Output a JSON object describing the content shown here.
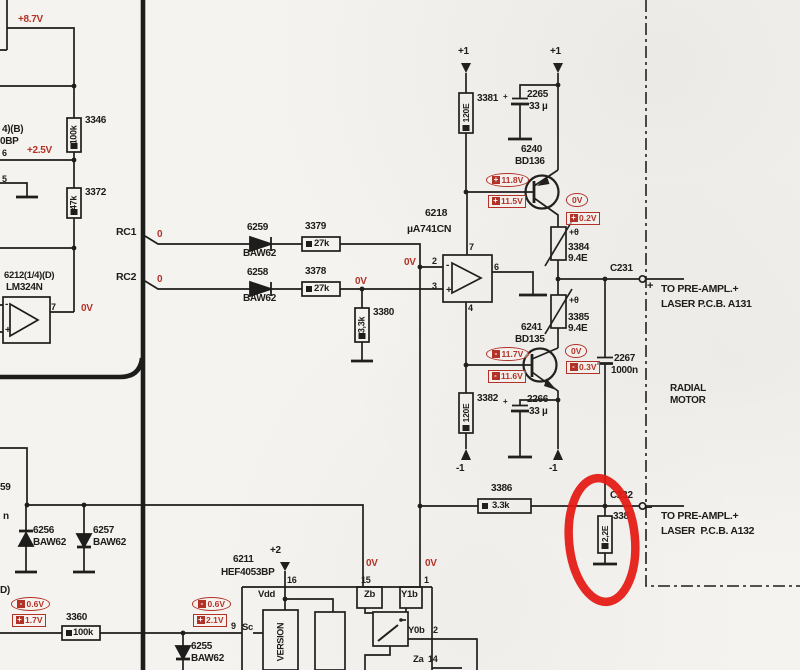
{
  "colors": {
    "line": "#1d1d1b",
    "print_red": "#b23227",
    "highlight_red": "#e41a12",
    "paper": "#f5f3ef"
  },
  "highlight": {
    "shape": "hand-drawn-ellipse",
    "around": "2.2E resistor at connector C232"
  },
  "labels": [
    {
      "n": "voltage-8p7v",
      "t": "+8.7V",
      "x": 18,
      "y": 15,
      "c": "r"
    },
    {
      "n": "frag-ic-b",
      "t": "4)(B)",
      "x": 2,
      "y": 125,
      "c": "b"
    },
    {
      "n": "frag-ic-bp",
      "t": "0BP",
      "x": 0,
      "y": 137,
      "c": "b"
    },
    {
      "n": "res-3346-id",
      "t": "3346",
      "x": 85,
      "y": 116,
      "c": "b"
    },
    {
      "n": "res-3346-val",
      "t": "100k",
      "x": 74,
      "y": 135,
      "c": "b",
      "rot": 1,
      "s": 9
    },
    {
      "n": "voltage-2p5v",
      "t": "+2.5V",
      "x": 27,
      "y": 146,
      "c": "r"
    },
    {
      "n": "pin-6-left",
      "t": "6",
      "x": 2,
      "y": 149,
      "c": "b",
      "s": 9
    },
    {
      "n": "pin-5-left",
      "t": "5",
      "x": 2,
      "y": 175,
      "c": "b",
      "s": 9
    },
    {
      "n": "res-3372-id",
      "t": "3372",
      "x": 85,
      "y": 188,
      "c": "b"
    },
    {
      "n": "res-3372-val",
      "t": "47k",
      "x": 74,
      "y": 203,
      "c": "b",
      "rot": 1,
      "s": 9
    },
    {
      "n": "ic-6212-id",
      "t": "6212(1/4)(D)",
      "x": 4,
      "y": 271,
      "c": "b",
      "s": 9.5
    },
    {
      "n": "ic-6212-type",
      "t": "LM324N",
      "x": 6,
      "y": 283,
      "c": "b"
    },
    {
      "n": "lm324-pin7",
      "t": "7",
      "x": 51,
      "y": 303,
      "c": "b",
      "s": 9
    },
    {
      "n": "lm324-minus",
      "t": "-",
      "x": 5,
      "y": 300,
      "c": "b",
      "s": 10
    },
    {
      "n": "lm324-plus",
      "t": "+",
      "x": 5,
      "y": 326,
      "c": "b",
      "s": 10
    },
    {
      "n": "voltage-0v-lm324",
      "t": "0V",
      "x": 81,
      "y": 304,
      "c": "r"
    },
    {
      "n": "signal-rc1",
      "t": "RC1",
      "x": 116,
      "y": 227,
      "c": "b",
      "s": 10.5
    },
    {
      "n": "signal-rc2",
      "t": "RC2",
      "x": 116,
      "y": 272,
      "c": "b",
      "s": 10.5
    },
    {
      "n": "rc1-level-0",
      "t": "0",
      "x": 157,
      "y": 230,
      "c": "r"
    },
    {
      "n": "rc2-level-0",
      "t": "0",
      "x": 157,
      "y": 275,
      "c": "r"
    },
    {
      "n": "diode-6259-id",
      "t": "6259",
      "x": 247,
      "y": 223,
      "c": "b"
    },
    {
      "n": "diode-6259-type",
      "t": "BAW62",
      "x": 243,
      "y": 249,
      "c": "b"
    },
    {
      "n": "diode-6258-id",
      "t": "6258",
      "x": 247,
      "y": 268,
      "c": "b"
    },
    {
      "n": "diode-6258-type",
      "t": "BAW62",
      "x": 243,
      "y": 294,
      "c": "b"
    },
    {
      "n": "res-3379-id",
      "t": "3379",
      "x": 305,
      "y": 222,
      "c": "b"
    },
    {
      "n": "res-3379-val",
      "t": "27k",
      "x": 314,
      "y": 239,
      "c": "b",
      "s": 9.5
    },
    {
      "n": "res-3378-id",
      "t": "3378",
      "x": 305,
      "y": 267,
      "c": "b"
    },
    {
      "n": "res-3378-val",
      "t": "27k",
      "x": 314,
      "y": 284,
      "c": "b",
      "s": 9.5
    },
    {
      "n": "voltage-0v-3380",
      "t": "0V",
      "x": 355,
      "y": 277,
      "c": "r"
    },
    {
      "n": "res-3380-id",
      "t": "3380",
      "x": 373,
      "y": 308,
      "c": "b"
    },
    {
      "n": "res-3380-val",
      "t": "3,3k",
      "x": 362,
      "y": 325,
      "c": "b",
      "rot": 1,
      "s": 9
    },
    {
      "n": "opamp-6218-id",
      "t": "6218",
      "x": 425,
      "y": 208,
      "c": "b",
      "s": 10.5
    },
    {
      "n": "opamp-6218-type",
      "t": "µA741CN",
      "x": 407,
      "y": 224,
      "c": "b",
      "s": 10.5
    },
    {
      "n": "voltage-0v-pin2",
      "t": "0V",
      "x": 404,
      "y": 258,
      "c": "r"
    },
    {
      "n": "opamp-pin2",
      "t": "2",
      "x": 432,
      "y": 257,
      "c": "b",
      "s": 9
    },
    {
      "n": "opamp-pin3",
      "t": "3",
      "x": 432,
      "y": 282,
      "c": "b",
      "s": 9
    },
    {
      "n": "opamp-pin7",
      "t": "7",
      "x": 469,
      "y": 243,
      "c": "b",
      "s": 9
    },
    {
      "n": "opamp-pin4",
      "t": "4",
      "x": 468,
      "y": 304,
      "c": "b",
      "s": 9
    },
    {
      "n": "opamp-pin6",
      "t": "6",
      "x": 494,
      "y": 263,
      "c": "b",
      "s": 9
    },
    {
      "n": "opamp-minus",
      "t": "-",
      "x": 446,
      "y": 261,
      "c": "b",
      "s": 10
    },
    {
      "n": "opamp-plus",
      "t": "+",
      "x": 446,
      "y": 286,
      "c": "b",
      "s": 10
    },
    {
      "n": "supply-plus1-left",
      "t": "+1",
      "x": 458,
      "y": 47,
      "c": "b"
    },
    {
      "n": "supply-plus1-right",
      "t": "+1",
      "x": 550,
      "y": 47,
      "c": "b"
    },
    {
      "n": "res-3381-id",
      "t": "3381",
      "x": 477,
      "y": 94,
      "c": "b"
    },
    {
      "n": "res-3381-val",
      "t": "120E",
      "x": 466,
      "y": 113,
      "c": "b",
      "rot": 1,
      "s": 8.5
    },
    {
      "n": "cap-2265-polarity",
      "t": "+",
      "x": 503,
      "y": 93,
      "c": "b",
      "s": 8
    },
    {
      "n": "cap-2265-id",
      "t": "2265",
      "x": 527,
      "y": 90,
      "c": "b"
    },
    {
      "n": "cap-2265-val",
      "t": "33 µ",
      "x": 529,
      "y": 102,
      "c": "b"
    },
    {
      "n": "transistor-6240-id",
      "t": "6240",
      "x": 521,
      "y": 145,
      "c": "b"
    },
    {
      "n": "transistor-6240-type",
      "t": "BD136",
      "x": 515,
      "y": 157,
      "c": "b"
    },
    {
      "n": "ptc-3384-theta",
      "t": "+θ",
      "x": 569,
      "y": 228,
      "c": "b",
      "s": 9
    },
    {
      "n": "ptc-3384-id",
      "t": "3384",
      "x": 568,
      "y": 243,
      "c": "b"
    },
    {
      "n": "ptc-3384-val",
      "t": "9.4E",
      "x": 568,
      "y": 254,
      "c": "b"
    },
    {
      "n": "conn-c231-id",
      "t": "C231",
      "x": 610,
      "y": 264,
      "c": "b"
    },
    {
      "n": "conn-c231-plus",
      "t": "+",
      "x": 647,
      "y": 281,
      "c": "b",
      "s": 11
    },
    {
      "n": "dest-a131-line1",
      "t": "TO PRE-AMPL.+",
      "x": 661,
      "y": 284,
      "c": "b",
      "s": 10.5
    },
    {
      "n": "dest-a131-line2",
      "t": "LASER P.C.B. A131",
      "x": 661,
      "y": 299,
      "c": "b",
      "s": 10.5
    },
    {
      "n": "ptc-3385-theta",
      "t": "+θ",
      "x": 569,
      "y": 296,
      "c": "b",
      "s": 9
    },
    {
      "n": "ptc-3385-id",
      "t": "3385",
      "x": 568,
      "y": 313,
      "c": "b"
    },
    {
      "n": "ptc-3385-val",
      "t": "9.4E",
      "x": 568,
      "y": 324,
      "c": "b"
    },
    {
      "n": "transistor-6241-id",
      "t": "6241",
      "x": 521,
      "y": 323,
      "c": "b"
    },
    {
      "n": "transistor-6241-type",
      "t": "BD135",
      "x": 515,
      "y": 335,
      "c": "b"
    },
    {
      "n": "cap-2267-id",
      "t": "2267",
      "x": 614,
      "y": 354,
      "c": "b"
    },
    {
      "n": "cap-2267-val",
      "t": "1000n",
      "x": 611,
      "y": 366,
      "c": "b"
    },
    {
      "n": "label-radial",
      "t": "RADIAL",
      "x": 670,
      "y": 384,
      "c": "b"
    },
    {
      "n": "label-motor",
      "t": "MOTOR",
      "x": 670,
      "y": 396,
      "c": "b"
    },
    {
      "n": "res-3382-id",
      "t": "3382",
      "x": 477,
      "y": 394,
      "c": "b"
    },
    {
      "n": "res-3382-val",
      "t": "120E",
      "x": 466,
      "y": 413,
      "c": "b",
      "rot": 1,
      "s": 8.5
    },
    {
      "n": "cap-2266-polarity",
      "t": "+",
      "x": 503,
      "y": 398,
      "c": "b",
      "s": 8
    },
    {
      "n": "cap-2266-id",
      "t": "2266",
      "x": 527,
      "y": 395,
      "c": "b"
    },
    {
      "n": "cap-2266-val",
      "t": "33 µ",
      "x": 529,
      "y": 407,
      "c": "b"
    },
    {
      "n": "supply-minus1-left",
      "t": "-1",
      "x": 456,
      "y": 464,
      "c": "b"
    },
    {
      "n": "supply-minus1-right",
      "t": "-1",
      "x": 549,
      "y": 464,
      "c": "b"
    },
    {
      "n": "frag-59",
      "t": "59",
      "x": 0,
      "y": 483,
      "c": "b"
    },
    {
      "n": "frag-n",
      "t": "n",
      "x": 3,
      "y": 512,
      "c": "b"
    },
    {
      "n": "res-3386-id",
      "t": "3386",
      "x": 491,
      "y": 484,
      "c": "b"
    },
    {
      "n": "res-3386-val",
      "t": "3.3k",
      "x": 492,
      "y": 501,
      "c": "b",
      "s": 9.5
    },
    {
      "n": "conn-c232-id",
      "t": "C232",
      "x": 610,
      "y": 491,
      "c": "b"
    },
    {
      "n": "conn-c232-minus",
      "t": "−",
      "x": 646,
      "y": 503,
      "c": "b",
      "s": 11
    },
    {
      "n": "dest-a132-line1",
      "t": "TO PRE-AMPL.+",
      "x": 661,
      "y": 511,
      "c": "b",
      "s": 10.5
    },
    {
      "n": "dest-a132-line2",
      "t": "LASER  P.C.B. A132",
      "x": 661,
      "y": 526,
      "c": "b",
      "s": 10.5
    },
    {
      "n": "res-2r2-id",
      "t": "338",
      "x": 613,
      "y": 512,
      "c": "b"
    },
    {
      "n": "res-2r2-val",
      "t": "2,2E",
      "x": 605,
      "y": 534,
      "c": "b",
      "rot": 1,
      "s": 8.5
    },
    {
      "n": "diode-6256-id",
      "t": "6256",
      "x": 33,
      "y": 526,
      "c": "b"
    },
    {
      "n": "diode-6256-type",
      "t": "BAW62",
      "x": 33,
      "y": 538,
      "c": "b"
    },
    {
      "n": "diode-6257-id",
      "t": "6257",
      "x": 93,
      "y": 526,
      "c": "b"
    },
    {
      "n": "diode-6257-type",
      "t": "BAW62",
      "x": 93,
      "y": 538,
      "c": "b"
    },
    {
      "n": "frag-d",
      "t": "D)",
      "x": 0,
      "y": 586,
      "c": "b"
    },
    {
      "n": "ic-6211-id",
      "t": "6211",
      "x": 233,
      "y": 555,
      "c": "b"
    },
    {
      "n": "ic-6211-type",
      "t": "HEF4053BP",
      "x": 221,
      "y": 568,
      "c": "b"
    },
    {
      "n": "supply-plus2",
      "t": "+2",
      "x": 270,
      "y": 546,
      "c": "b"
    },
    {
      "n": "chip-pin16",
      "t": "16",
      "x": 287,
      "y": 576,
      "c": "b",
      "s": 9
    },
    {
      "n": "chip-vdd",
      "t": "Vdd",
      "x": 258,
      "y": 590,
      "c": "b",
      "s": 9.5
    },
    {
      "n": "voltage-0v-zb",
      "t": "0V",
      "x": 366,
      "y": 559,
      "c": "r"
    },
    {
      "n": "voltage-0v-y1b",
      "t": "0V",
      "x": 425,
      "y": 559,
      "c": "r"
    },
    {
      "n": "chip-pin15",
      "t": "15",
      "x": 361,
      "y": 576,
      "c": "b",
      "s": 9
    },
    {
      "n": "chip-zb",
      "t": "Zb",
      "x": 364,
      "y": 590,
      "c": "b",
      "s": 9.5
    },
    {
      "n": "chip-pin1",
      "t": "1",
      "x": 424,
      "y": 576,
      "c": "b",
      "s": 9
    },
    {
      "n": "chip-y1b",
      "t": "Y1b",
      "x": 401,
      "y": 590,
      "c": "b",
      "s": 9.5
    },
    {
      "n": "chip-pin9",
      "t": "9",
      "x": 231,
      "y": 622,
      "c": "b",
      "s": 9
    },
    {
      "n": "chip-sc",
      "t": "Sc",
      "x": 242,
      "y": 623,
      "c": "b",
      "s": 9.5
    },
    {
      "n": "chip-y0b",
      "t": "Y0b",
      "x": 408,
      "y": 626,
      "c": "b",
      "s": 9.5
    },
    {
      "n": "chip-pin2",
      "t": "2",
      "x": 433,
      "y": 626,
      "c": "b",
      "s": 9
    },
    {
      "n": "chip-za",
      "t": "Za",
      "x": 413,
      "y": 655,
      "c": "b",
      "s": 9.5
    },
    {
      "n": "chip-pin14",
      "t": "14",
      "x": 428,
      "y": 655,
      "c": "b",
      "s": 9
    },
    {
      "n": "chip-version",
      "t": "VERSION",
      "x": 281,
      "y": 642,
      "c": "b",
      "rot": 1,
      "s": 9
    },
    {
      "n": "res-3360-id",
      "t": "3360",
      "x": 66,
      "y": 613,
      "c": "b"
    },
    {
      "n": "res-3360-val",
      "t": "100k",
      "x": 73,
      "y": 628,
      "c": "b",
      "s": 9.5
    },
    {
      "n": "diode-6255-id",
      "t": "6255",
      "x": 191,
      "y": 642,
      "c": "b"
    },
    {
      "n": "diode-6255-type",
      "t": "BAW62",
      "x": 191,
      "y": 654,
      "c": "b"
    }
  ],
  "callouts": [
    {
      "n": "meas-plus11p8v",
      "shape": "oval",
      "sign": "+",
      "val": "11.8V",
      "x": 486,
      "y": 173
    },
    {
      "n": "meas-plus11p5v",
      "shape": "box",
      "sign": "+",
      "val": "11.5V",
      "x": 488,
      "y": 195
    },
    {
      "n": "meas-0v-top",
      "shape": "oval",
      "sign": "",
      "val": "0V",
      "x": 566,
      "y": 193
    },
    {
      "n": "meas-plus0p2v",
      "shape": "box",
      "sign": "+",
      "val": "0.2V",
      "x": 566,
      "y": 212
    },
    {
      "n": "meas-minus11p7v",
      "shape": "oval",
      "sign": "-",
      "val": "11.7V",
      "x": 486,
      "y": 347
    },
    {
      "n": "meas-minus11p6v",
      "shape": "box",
      "sign": "-",
      "val": "11.6V",
      "x": 488,
      "y": 370
    },
    {
      "n": "meas-0v-bottom",
      "shape": "oval",
      "sign": "",
      "val": "0V",
      "x": 565,
      "y": 344
    },
    {
      "n": "meas-minus0p3v",
      "shape": "box",
      "sign": "-",
      "val": "0.3V",
      "x": 566,
      "y": 361
    },
    {
      "n": "meas-minus0p6v-left",
      "shape": "oval",
      "sign": "-",
      "val": "0.6V",
      "x": 11,
      "y": 597
    },
    {
      "n": "meas-plus1p7v",
      "shape": "box",
      "sign": "+",
      "val": "1.7V",
      "x": 12,
      "y": 614
    },
    {
      "n": "meas-minus0p6v-right",
      "shape": "oval",
      "sign": "-",
      "val": "0.6V",
      "x": 192,
      "y": 597
    },
    {
      "n": "meas-plus2p1v",
      "shape": "box",
      "sign": "+",
      "val": "2.1V",
      "x": 193,
      "y": 614
    }
  ]
}
